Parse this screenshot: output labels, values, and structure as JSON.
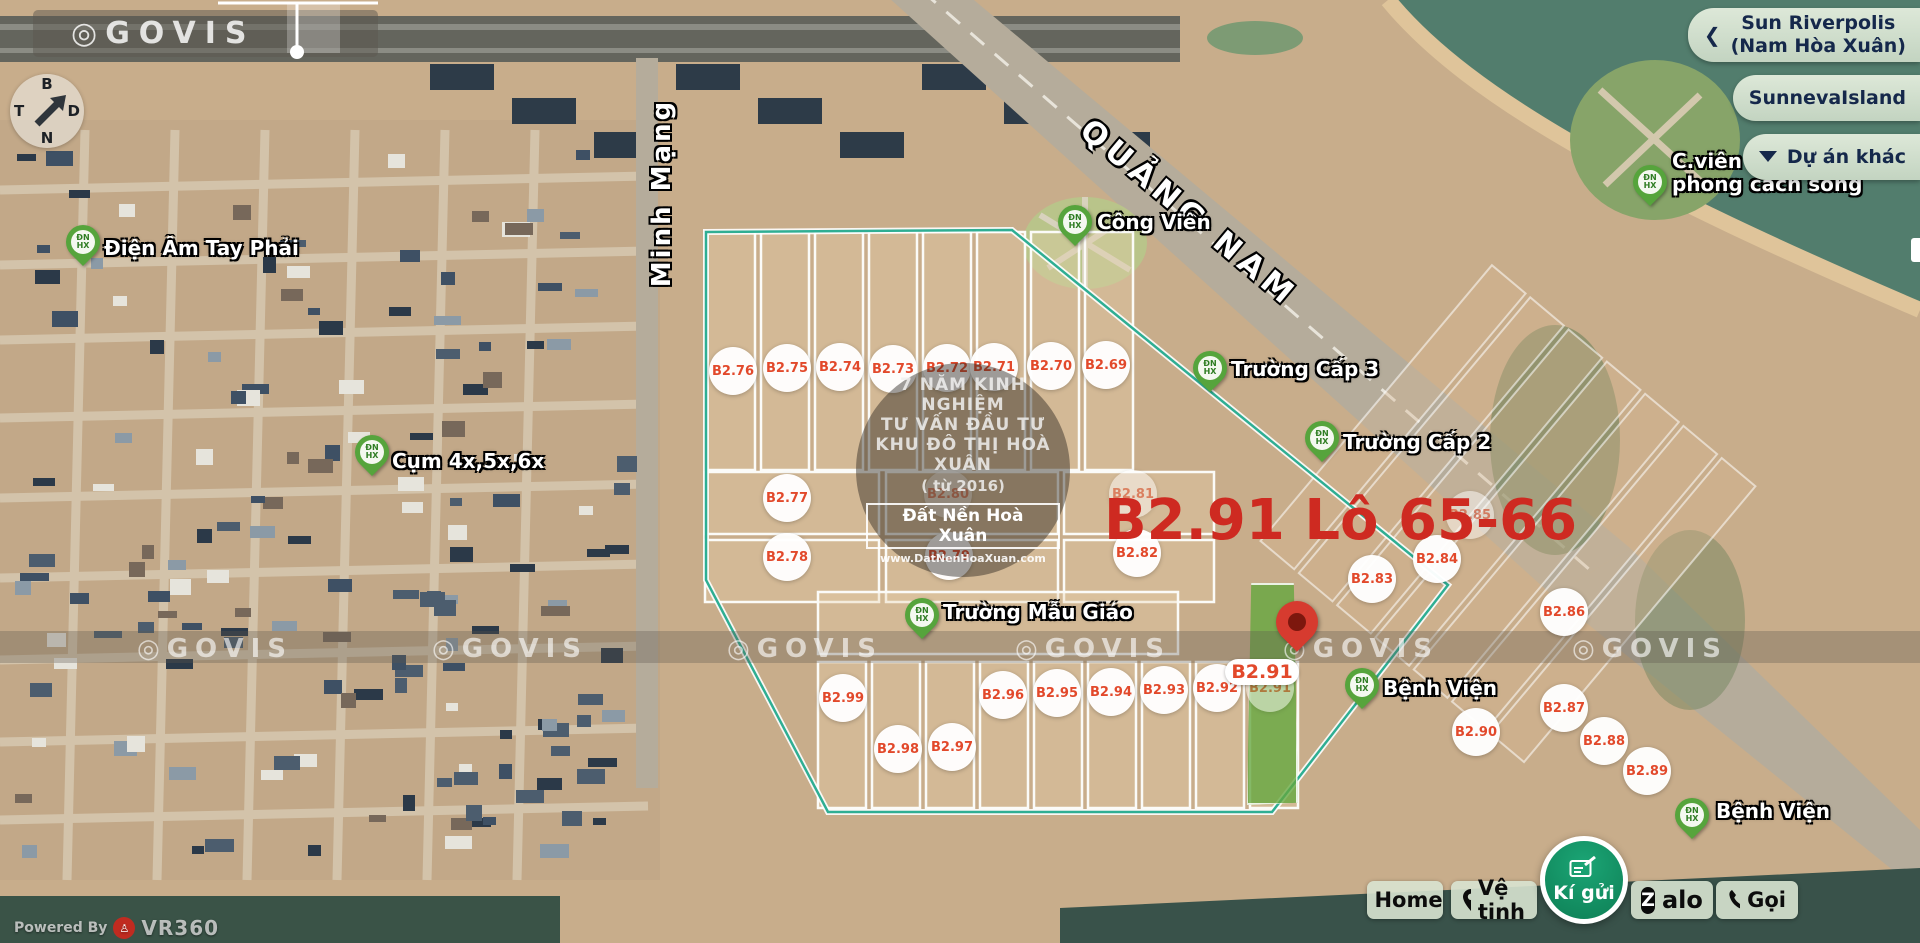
{
  "brand": {
    "glyph": "◎",
    "name": "GOVIS"
  },
  "compass": {
    "top": "B",
    "right": "D",
    "bottom": "N",
    "left": "T"
  },
  "streets": [
    {
      "name": "QUẢNG NAM"
    },
    {
      "name": "Minh Mạng"
    }
  ],
  "top_right_projects": {
    "chevron": "❮",
    "item1_line1": "Sun Riverpolis",
    "item1_line2": "(Nam Hòa Xuân)",
    "item2": "SunnevaIsland",
    "item3": "Dự án khác"
  },
  "center_watermark": {
    "line1": "7 NĂM KINH NGHIỆM",
    "line2": "TƯ VẤN ĐẦU TƯ",
    "line3": "KHU ĐÔ THỊ HOÀ XUÂN",
    "line4": "( từ 2016)",
    "brand_box": "Đất Nền Hoà Xuân",
    "website": "www.DatNenHoaXuan.com"
  },
  "selection": {
    "headline": "B2.91 Lô 65-66",
    "tag": "B2.91"
  },
  "pin_monogram": "ĐN\nHX",
  "lots": [
    {
      "id": "B2.76",
      "x": 733,
      "y": 371
    },
    {
      "id": "B2.75",
      "x": 787,
      "y": 368
    },
    {
      "id": "B2.74",
      "x": 840,
      "y": 367
    },
    {
      "id": "B2.73",
      "x": 893,
      "y": 369
    },
    {
      "id": "B2.72",
      "x": 947,
      "y": 368
    },
    {
      "id": "B2.71",
      "x": 994,
      "y": 367
    },
    {
      "id": "B2.70",
      "x": 1051,
      "y": 366
    },
    {
      "id": "B2.69",
      "x": 1106,
      "y": 365
    },
    {
      "id": "B2.77",
      "x": 787,
      "y": 498
    },
    {
      "id": "B2.78",
      "x": 787,
      "y": 557
    },
    {
      "id": "B2.80",
      "x": 948,
      "y": 494,
      "faded": true
    },
    {
      "id": "B2.79",
      "x": 949,
      "y": 556
    },
    {
      "id": "B2.81",
      "x": 1133,
      "y": 494,
      "faded": true
    },
    {
      "id": "B2.82",
      "x": 1137,
      "y": 553
    },
    {
      "id": "B2.83",
      "x": 1372,
      "y": 579
    },
    {
      "id": "B2.84",
      "x": 1437,
      "y": 559
    },
    {
      "id": "B2.85",
      "x": 1470,
      "y": 515,
      "faded": true
    },
    {
      "id": "B2.86",
      "x": 1564,
      "y": 612
    },
    {
      "id": "B2.87",
      "x": 1564,
      "y": 708
    },
    {
      "id": "B2.88",
      "x": 1604,
      "y": 741
    },
    {
      "id": "B2.89",
      "x": 1647,
      "y": 771
    },
    {
      "id": "B2.90",
      "x": 1476,
      "y": 732
    },
    {
      "id": "B2.99",
      "x": 843,
      "y": 698
    },
    {
      "id": "B2.98",
      "x": 898,
      "y": 749
    },
    {
      "id": "B2.97",
      "x": 952,
      "y": 747
    },
    {
      "id": "B2.96",
      "x": 1003,
      "y": 695
    },
    {
      "id": "B2.95",
      "x": 1057,
      "y": 693
    },
    {
      "id": "B2.94",
      "x": 1111,
      "y": 692
    },
    {
      "id": "B2.93",
      "x": 1164,
      "y": 690
    },
    {
      "id": "B2.92",
      "x": 1217,
      "y": 688
    },
    {
      "id": "B2.91",
      "x": 1270,
      "y": 688,
      "faded": true
    }
  ],
  "pois": [
    {
      "label": "Điện Âm Tay Phải",
      "pin_x": 83,
      "pin_y": 272,
      "tx": 104,
      "ty": 237
    },
    {
      "label": "Cụm 4x,5x,6x",
      "pin_x": 372,
      "pin_y": 482,
      "tx": 392,
      "ty": 450
    },
    {
      "label": "Công Viên",
      "pin_x": 1075,
      "pin_y": 252,
      "tx": 1097,
      "ty": 211
    },
    {
      "label": "Trường Cấp 3",
      "pin_x": 1210,
      "pin_y": 398,
      "tx": 1231,
      "ty": 358
    },
    {
      "label": "Trường Cấp 2",
      "pin_x": 1322,
      "pin_y": 468,
      "tx": 1343,
      "ty": 431
    },
    {
      "label": "Trường Mẫu Giáo",
      "pin_x": 922,
      "pin_y": 645,
      "tx": 943,
      "ty": 601
    },
    {
      "label": "Bệnh Viện",
      "pin_x": 1362,
      "pin_y": 715,
      "tx": 1383,
      "ty": 677
    },
    {
      "label": "C.viên\nphong cách sống",
      "pin_x": 1650,
      "pin_y": 212,
      "tx": 1672,
      "ty": 150
    },
    {
      "label": "Bệnh Viện",
      "pin_x": 1692,
      "pin_y": 845,
      "tx": 1716,
      "ty": 800
    }
  ],
  "watermark_band": {
    "centers": [
      215,
      510,
      805,
      1093,
      1361,
      1650
    ]
  },
  "toolbar": {
    "home": "Home",
    "satellite": "Vệ tinh",
    "consign": "Kí gửi",
    "zalo_z": "Z",
    "zalo_rest": "alo",
    "call": "Gọi"
  },
  "credit": {
    "powered_by": "Powered By",
    "logo_letters": "VR",
    "brand": "VR360"
  }
}
